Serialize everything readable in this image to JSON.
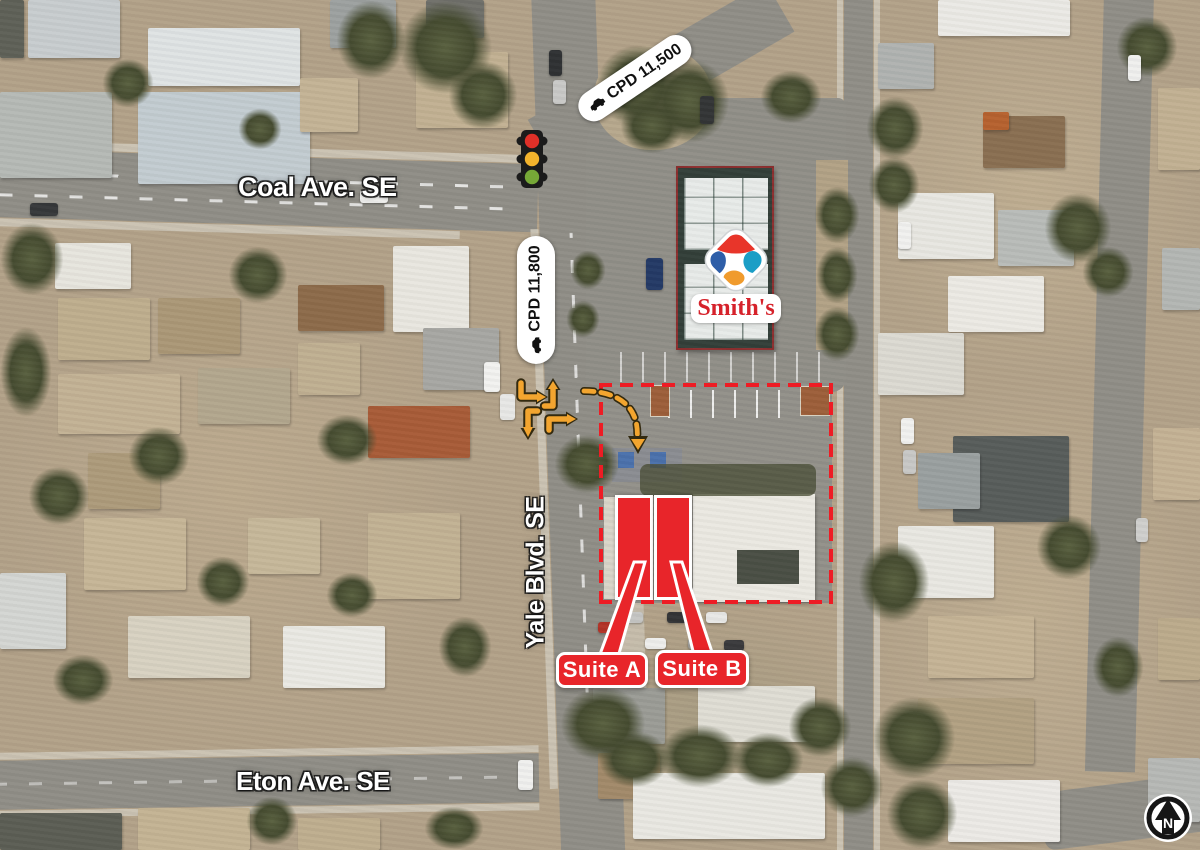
{
  "map": {
    "streets": {
      "coal": "Coal Ave. SE",
      "yale": "Yale Blvd. SE",
      "eton": "Eton Ave. SE"
    },
    "traffic_counts": {
      "coal": "CPD 11,500",
      "yale": "CPD 11,800"
    },
    "suites": {
      "a": "Suite A",
      "b": "Suite B"
    },
    "brand": {
      "name": "Smith's"
    },
    "compass": {
      "label": "N"
    },
    "icons": {
      "traffic_light": "traffic-light-icon",
      "car": "car-icon",
      "north_arrow": "north-arrow-icon",
      "brand_logo": "smiths-logo-icon",
      "turn_arrows": "turn-arrow-icons",
      "entry_arrow": "site-entry-arrow-icon"
    },
    "colors": {
      "annotation_red": "#e8252a",
      "boundary_red": "#ee1c24",
      "arrow_orange": "#f3a52f",
      "pill_background": "#ffffff",
      "pill_text": "#111111",
      "street_label": "#ffffff",
      "smiths_red": "#d6222b"
    }
  }
}
